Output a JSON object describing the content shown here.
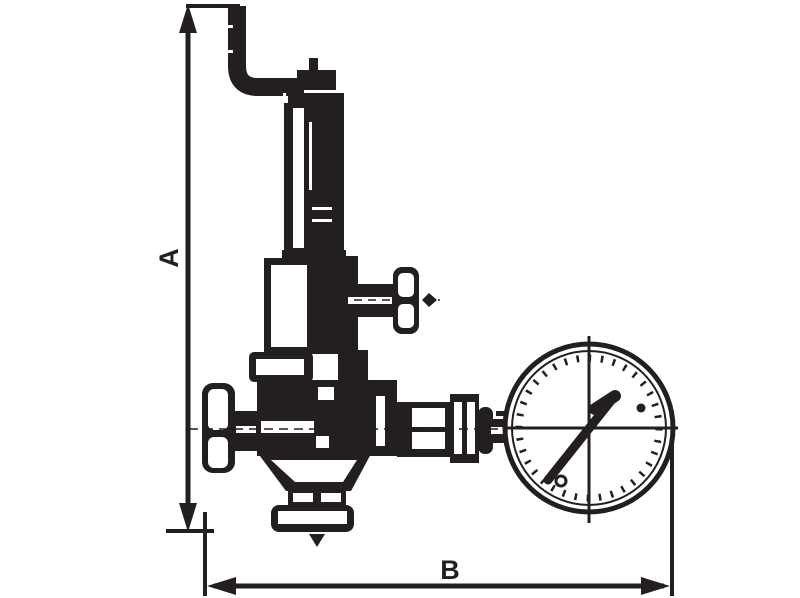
{
  "diagram": {
    "type": "technical-line-drawing",
    "subject": "pressure-reducing-valve-with-gauge",
    "ink_color": "#231f20",
    "background_color": "#ffffff",
    "dimensions": [
      {
        "label": "A",
        "orientation": "vertical"
      },
      {
        "label": "B",
        "orientation": "horizontal"
      }
    ],
    "parts": [
      {
        "name": "inlet-pipe-elbow"
      },
      {
        "name": "adjusting-screw-cap"
      },
      {
        "name": "spring-housing"
      },
      {
        "name": "bonnet"
      },
      {
        "name": "side-tap-t-handle"
      },
      {
        "name": "flange-nut"
      },
      {
        "name": "valve-body"
      },
      {
        "name": "shutoff-handwheel"
      },
      {
        "name": "gauge-connection-fittings"
      },
      {
        "name": "pressure-gauge"
      },
      {
        "name": "gauge-needle"
      },
      {
        "name": "bottom-outlet-flange"
      },
      {
        "name": "drain-tip"
      }
    ]
  }
}
